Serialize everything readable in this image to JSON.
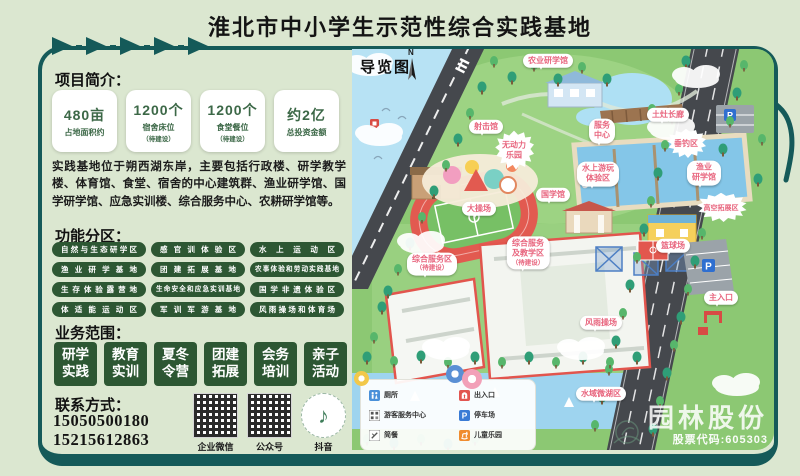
{
  "title": "淮北市中小学生示范性综合实践基地",
  "colors": {
    "frame_teal": "#155a59",
    "pill_green": "#2d5733",
    "stat_green": "#3c6847",
    "map_label_pink": "#e8657e"
  },
  "panel": {
    "intro_heading": "项目简介：",
    "stats": [
      {
        "value": "480亩",
        "label": "占地面积约",
        "note": ""
      },
      {
        "value": "1200个",
        "label": "宿舍床位",
        "note": "（待建设）"
      },
      {
        "value": "1200个",
        "label": "食堂餐位",
        "note": "（待建设）"
      },
      {
        "value": "约2亿",
        "label": "总投资金额",
        "note": ""
      }
    ],
    "description": "实践基地位于朔西湖东岸，主要包括行政楼、研学教学楼、体育馆、食堂、宿舍的中心建筑群、渔业研学馆、国学研学馆、应急实训楼、综合服务中心、农耕研学馆等。",
    "zones_heading": "功能分区：",
    "zones": [
      "自然与生态研学区",
      "感官训体验区",
      "水上运动区",
      "渔业研学基地",
      "团建拓展基地",
      "农事体验和劳动实践基地",
      "生存体验露营地",
      "生命安全和应急实训基地",
      "国学非遗体验区",
      "体适能运动区",
      "军训军游基地",
      "风雨操场和体育场"
    ],
    "business_heading": "业务范围：",
    "business": [
      {
        "line1": "研学",
        "line2": "实践"
      },
      {
        "line1": "教育",
        "line2": "实训"
      },
      {
        "line1": "夏冬",
        "line2": "令营"
      },
      {
        "line1": "团建",
        "line2": "拓展"
      },
      {
        "line1": "会务",
        "line2": "培训"
      },
      {
        "line1": "亲子",
        "line2": "活动"
      }
    ],
    "contact_heading": "联系方式：",
    "phones": [
      "15050500180",
      "15215612863"
    ],
    "qr_labels": [
      "企业微信",
      "公众号",
      "抖音"
    ],
    "douyin_glyph": "♪"
  },
  "map": {
    "title": "导览图",
    "compass": "N",
    "labels": [
      {
        "text": "农业研学馆",
        "note": ""
      },
      {
        "text": "射击馆",
        "note": ""
      },
      {
        "text": "无动力\n乐园",
        "note": ""
      },
      {
        "text": "服务\n中心",
        "note": ""
      },
      {
        "text": "土灶长廊",
        "note": ""
      },
      {
        "text": "垂钓区",
        "note": ""
      },
      {
        "text": "水上游玩\n体验区",
        "note": ""
      },
      {
        "text": "渔业\n研学馆",
        "note": ""
      },
      {
        "text": "国学馆",
        "note": ""
      },
      {
        "text": "大操场",
        "note": ""
      },
      {
        "text": "高空拓展区",
        "note": ""
      },
      {
        "text": "综合服务区",
        "note": "（待建设）"
      },
      {
        "text": "综合服务\n及教学区",
        "note": "（待建设）"
      },
      {
        "text": "篮球场",
        "note": ""
      },
      {
        "text": "主入口",
        "note": ""
      },
      {
        "text": "风雨操场",
        "note": ""
      },
      {
        "text": "水域微湖区",
        "note": ""
      }
    ],
    "legend": {
      "items": [
        {
          "label": "厕所"
        },
        {
          "label": "游客服务中心"
        },
        {
          "label": "简餐"
        },
        {
          "label": "出入口"
        },
        {
          "label": "停车场"
        },
        {
          "label": "儿童乐园"
        }
      ],
      "parking_letter": "P"
    },
    "watermark": {
      "name": "园林股份",
      "code": "股票代码:605303"
    }
  }
}
